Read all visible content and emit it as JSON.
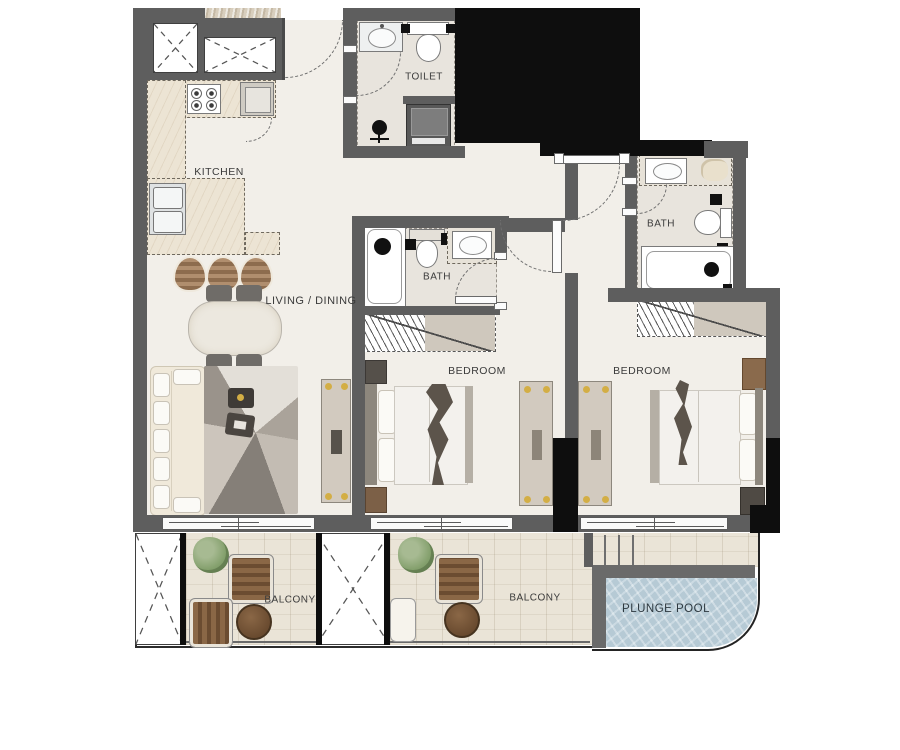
{
  "title": "Two-bedroom apartment floor plan",
  "labels": {
    "kitchen": "KITCHEN",
    "toilet": "TOILET",
    "living_dining": "LIVING / DINING",
    "bath_1": "BATH",
    "bath_2": "BATH",
    "bedroom_1": "BEDROOM",
    "bedroom_2": "BEDROOM",
    "balcony_1": "BALCONY",
    "balcony_2": "BALCONY",
    "plunge_pool": "PLUNGE POOL"
  },
  "colors": {
    "wall_gray": "#5e5e5e",
    "wall_black": "#0e0e0e",
    "floor_cream": "#f2efe9",
    "bath_tile": "#e8e4dd",
    "kitchen_counter": "#ece4d4",
    "balcony_wood": "#eae4d7",
    "pool_water": "#b6cad5",
    "exterior_stone": "#d8cebd",
    "accent_gold": "#d3ae45",
    "label_text": "#3b3b3b"
  }
}
